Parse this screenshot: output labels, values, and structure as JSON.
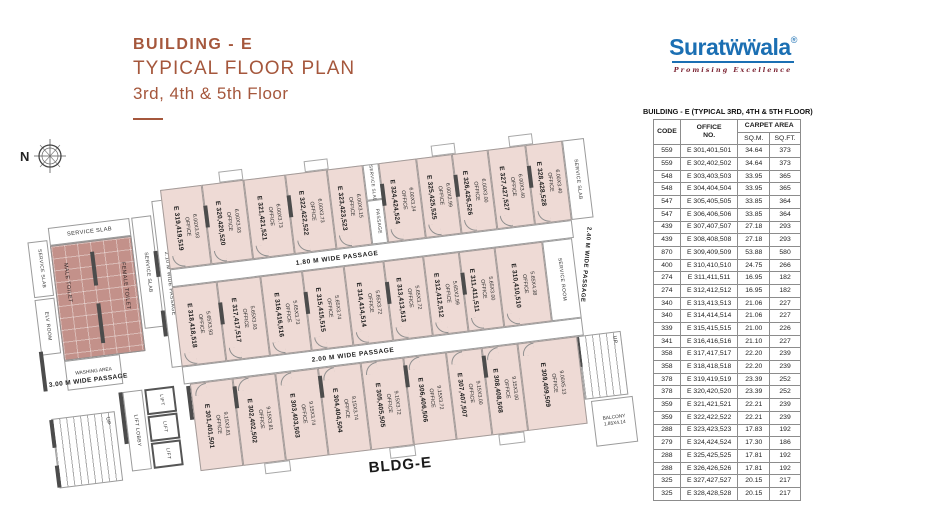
{
  "header": {
    "building": "BUILDING - E",
    "plan_type": "TYPICAL FLOOR PLAN",
    "floors": "3rd, 4th & 5th Floor"
  },
  "logo": {
    "brand": "Suratẅẅala",
    "registered": "®",
    "tagline": "Promising Excellence",
    "brand_color": "#1b6fb3",
    "tagline_color": "#7c2433"
  },
  "compass": {
    "label": "N"
  },
  "table": {
    "title": "BUILDING - E (TYPICAL 3RD, 4TH & 5TH FLOOR)",
    "columns": {
      "code": "CODE",
      "office_line1": "OFFICE",
      "office_line2": "NO.",
      "carpet": "CARPET AREA",
      "sqm": "SQ.M.",
      "sqft": "SQ.FT."
    },
    "rows": [
      [
        "559",
        "E 301,401,501",
        "34.64",
        "373"
      ],
      [
        "559",
        "E 302,402,502",
        "34.64",
        "373"
      ],
      [
        "548",
        "E 303,403,503",
        "33.95",
        "365"
      ],
      [
        "548",
        "E 304,404,504",
        "33.95",
        "365"
      ],
      [
        "547",
        "E 305,405,505",
        "33.85",
        "364"
      ],
      [
        "547",
        "E 306,406,506",
        "33.85",
        "364"
      ],
      [
        "439",
        "E 307,407,507",
        "27.18",
        "293"
      ],
      [
        "439",
        "E 308,408,508",
        "27.18",
        "293"
      ],
      [
        "870",
        "E 309,409,509",
        "53.88",
        "580"
      ],
      [
        "400",
        "E 310,410,510",
        "24.75",
        "266"
      ],
      [
        "274",
        "E 311,411,511",
        "16.95",
        "182"
      ],
      [
        "274",
        "E 312,412,512",
        "16.95",
        "182"
      ],
      [
        "340",
        "E 313,413,513",
        "21.06",
        "227"
      ],
      [
        "340",
        "E 314,414,514",
        "21.06",
        "227"
      ],
      [
        "339",
        "E 315,415,515",
        "21.00",
        "226"
      ],
      [
        "341",
        "E 316,416,516",
        "21.10",
        "227"
      ],
      [
        "358",
        "E 317,417,517",
        "22.20",
        "239"
      ],
      [
        "358",
        "E 318,418,518",
        "22.20",
        "239"
      ],
      [
        "378",
        "E 319,419,519",
        "23.39",
        "252"
      ],
      [
        "378",
        "E 320,420,520",
        "23.39",
        "252"
      ],
      [
        "359",
        "E 321,421,521",
        "22.21",
        "239"
      ],
      [
        "359",
        "E 322,422,522",
        "22.21",
        "239"
      ],
      [
        "288",
        "E 323,423,523",
        "17.83",
        "192"
      ],
      [
        "279",
        "E 324,424,524",
        "17.30",
        "186"
      ],
      [
        "288",
        "E 325,425,525",
        "17.81",
        "192"
      ],
      [
        "288",
        "E 326,426,526",
        "17.81",
        "192"
      ],
      [
        "325",
        "E 327,427,527",
        "20.15",
        "217"
      ],
      [
        "325",
        "E 328,428,528",
        "20.15",
        "217"
      ]
    ]
  },
  "plan": {
    "labels": {
      "office_word": "OFFICE",
      "service_slab": "SERVICE SLAB",
      "elv_room": "ELV ROOM",
      "male_toilet": "MALE TOILET",
      "female_toilet": "FEMALE TOILET",
      "washing_area": "WASHING AREA",
      "passage": "PASSAGE",
      "service_room": "SERVICE ROOM",
      "lift": "LIFT",
      "lift_lobby": "LIFT LOBBY",
      "up": "UP",
      "p180": "1.80 M WIDE PASSAGE",
      "p200": "2.00 M WIDE PASSAGE",
      "p210": "2.10 M WIDE PASSAGE",
      "p240": "2.40 M WIDE PASSAGE",
      "p300": "3.00 M WIDE PASSAGE",
      "balcony": "BALCONY",
      "balcony_dim": "1.85X4.14",
      "bldg": "BLDG-E"
    },
    "offices_top": [
      {
        "name": "E 319,419,519",
        "dim": "6.00X3.93"
      },
      {
        "name": "E 320,420,520",
        "dim": "6.00X3.93"
      },
      {
        "name": "E 321,421,521",
        "dim": "6.00X3.73"
      },
      {
        "name": "E 322,422,522",
        "dim": "6.00X3.73"
      },
      {
        "name": "E 323,423,523",
        "dim": "6.00X3.15"
      },
      {
        "name": "E 324,424,524",
        "dim": "6.00X3.24"
      },
      {
        "name": "E 325,425,525",
        "dim": "6.00X2.99"
      },
      {
        "name": "E 326,426,526",
        "dim": "6.00X3.00"
      },
      {
        "name": "E 327,427,527",
        "dim": "6.00X3.40"
      },
      {
        "name": "E 328,428,528",
        "dim": "6.00X3.40"
      }
    ],
    "offices_middle": [
      {
        "name": "E 318,418,518",
        "dim": "5.65X3.93"
      },
      {
        "name": "E 317,417,517",
        "dim": "5.65X3.93"
      },
      {
        "name": "E 316,416,516",
        "dim": "5.65X3.73"
      },
      {
        "name": "E 315,415,515",
        "dim": "5.65X3.74"
      },
      {
        "name": "E 314,414,514",
        "dim": "5.65X3.72"
      },
      {
        "name": "E 313,413,513",
        "dim": "5.65X3.72"
      },
      {
        "name": "E 312,412,512",
        "dim": "5.65X2.99"
      },
      {
        "name": "E 311,411,511",
        "dim": "5.65X3.00"
      },
      {
        "name": "E 310,410,510",
        "dim": "5.65X4.38"
      }
    ],
    "offices_bottom": [
      {
        "name": "E 301,401,501",
        "dim": "9.15X3.81"
      },
      {
        "name": "E 302,402,502",
        "dim": "9.15X3.81"
      },
      {
        "name": "E 303,403,503",
        "dim": "9.15X3.74"
      },
      {
        "name": "E 304,404,504",
        "dim": "9.15X3.74"
      },
      {
        "name": "E 305,405,505",
        "dim": "9.15X3.72"
      },
      {
        "name": "E 306,406,506",
        "dim": "9.15X3.72"
      },
      {
        "name": "E 307,407,507",
        "dim": "9.15X3.00"
      },
      {
        "name": "E 308,408,508",
        "dim": "9.15X3.00"
      },
      {
        "name": "E 309,409,509",
        "dim": "9.00X5.13"
      }
    ]
  }
}
